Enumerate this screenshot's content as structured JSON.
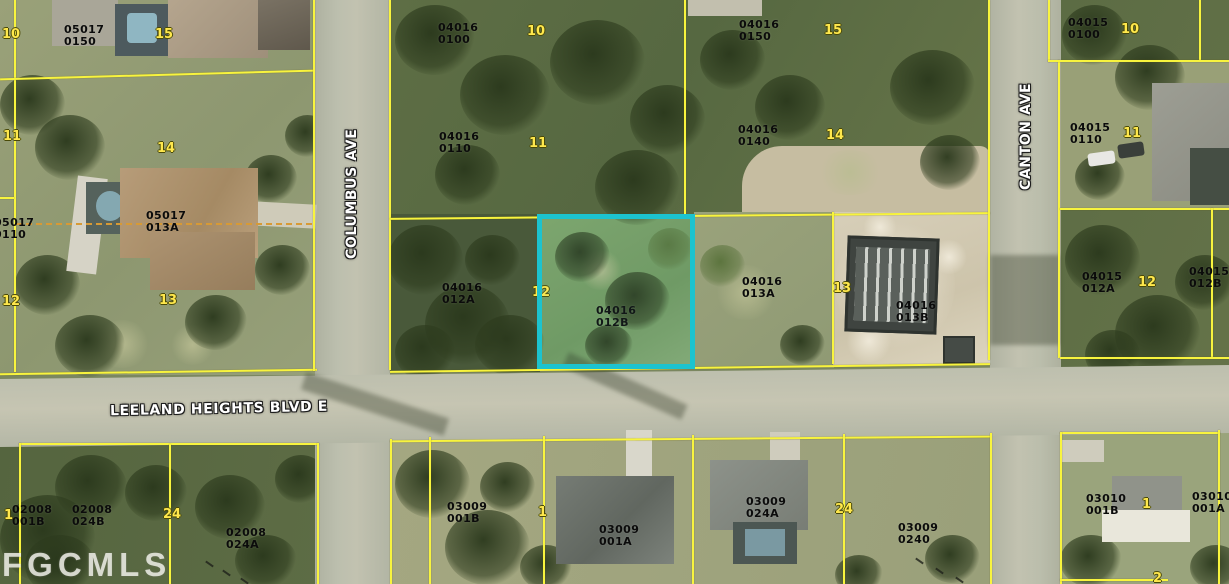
{
  "watermark": "FGCMLS",
  "streets": [
    {
      "name": "COLUMBUS AVE"
    },
    {
      "name": "CANTON AVE"
    },
    {
      "name": "LEELAND HEIGHTS BLVD E"
    }
  ],
  "highlight": {
    "parcel": "04016 012B",
    "color": "#1cc3cf"
  },
  "colors": {
    "parcel_line": "#f8f43e",
    "lot_number": "#ffe84d",
    "sub_parcel_dash": "#d79a35"
  },
  "parcel_labels": [
    {
      "line1": "05017",
      "line2": "0150",
      "x": 64,
      "y": 24
    },
    {
      "line1": "05017",
      "line2": "013A",
      "x": 146,
      "y": 210
    },
    {
      "line1": "05017",
      "line2": "0110",
      "x": -6,
      "y": 217
    },
    {
      "line1": "04016",
      "line2": "0100",
      "x": 438,
      "y": 22
    },
    {
      "line1": "04016",
      "line2": "0110",
      "x": 439,
      "y": 131
    },
    {
      "line1": "04016",
      "line2": "0150",
      "x": 739,
      "y": 19
    },
    {
      "line1": "04016",
      "line2": "0140",
      "x": 738,
      "y": 124
    },
    {
      "line1": "04016",
      "line2": "012A",
      "x": 442,
      "y": 282
    },
    {
      "line1": "04016",
      "line2": "012B",
      "x": 596,
      "y": 305
    },
    {
      "line1": "04016",
      "line2": "013A",
      "x": 742,
      "y": 276
    },
    {
      "line1": "04016",
      "line2": "013B",
      "x": 896,
      "y": 300
    },
    {
      "line1": "04015",
      "line2": "0100",
      "x": 1068,
      "y": 17
    },
    {
      "line1": "04015",
      "line2": "0110",
      "x": 1070,
      "y": 122
    },
    {
      "line1": "04015",
      "line2": "012A",
      "x": 1082,
      "y": 271
    },
    {
      "line1": "04015",
      "line2": "012B",
      "x": 1189,
      "y": 266
    },
    {
      "line1": "02008",
      "line2": "001B",
      "x": 12,
      "y": 504
    },
    {
      "line1": "02008",
      "line2": "024B",
      "x": 72,
      "y": 504
    },
    {
      "line1": "02008",
      "line2": "024A",
      "x": 226,
      "y": 527
    },
    {
      "line1": "03009",
      "line2": "001B",
      "x": 447,
      "y": 501
    },
    {
      "line1": "03009",
      "line2": "001A",
      "x": 599,
      "y": 524
    },
    {
      "line1": "03009",
      "line2": "024A",
      "x": 746,
      "y": 496
    },
    {
      "line1": "03009",
      "line2": "0240",
      "x": 898,
      "y": 522
    },
    {
      "line1": "03010",
      "line2": "001B",
      "x": 1086,
      "y": 493
    },
    {
      "line1": "03010",
      "line2": "001A",
      "x": 1192,
      "y": 491
    }
  ],
  "lot_numbers": [
    {
      "n": "10",
      "x": 2,
      "y": 28
    },
    {
      "n": "11",
      "x": 3,
      "y": 130
    },
    {
      "n": "12",
      "x": 2,
      "y": 295
    },
    {
      "n": "15",
      "x": 155,
      "y": 28
    },
    {
      "n": "14",
      "x": 157,
      "y": 142
    },
    {
      "n": "13",
      "x": 159,
      "y": 294
    },
    {
      "n": "10",
      "x": 527,
      "y": 25
    },
    {
      "n": "11",
      "x": 529,
      "y": 137
    },
    {
      "n": "12",
      "x": 532,
      "y": 286
    },
    {
      "n": "15",
      "x": 824,
      "y": 24
    },
    {
      "n": "14",
      "x": 826,
      "y": 129
    },
    {
      "n": "13",
      "x": 833,
      "y": 282
    },
    {
      "n": "10",
      "x": 1121,
      "y": 23
    },
    {
      "n": "11",
      "x": 1123,
      "y": 127
    },
    {
      "n": "12",
      "x": 1138,
      "y": 276
    },
    {
      "n": "1",
      "x": 4,
      "y": 509
    },
    {
      "n": "24",
      "x": 163,
      "y": 508
    },
    {
      "n": "1",
      "x": 538,
      "y": 506
    },
    {
      "n": "24",
      "x": 835,
      "y": 503
    },
    {
      "n": "1",
      "x": 1142,
      "y": 498
    },
    {
      "n": "2",
      "x": 1153,
      "y": 572
    }
  ]
}
